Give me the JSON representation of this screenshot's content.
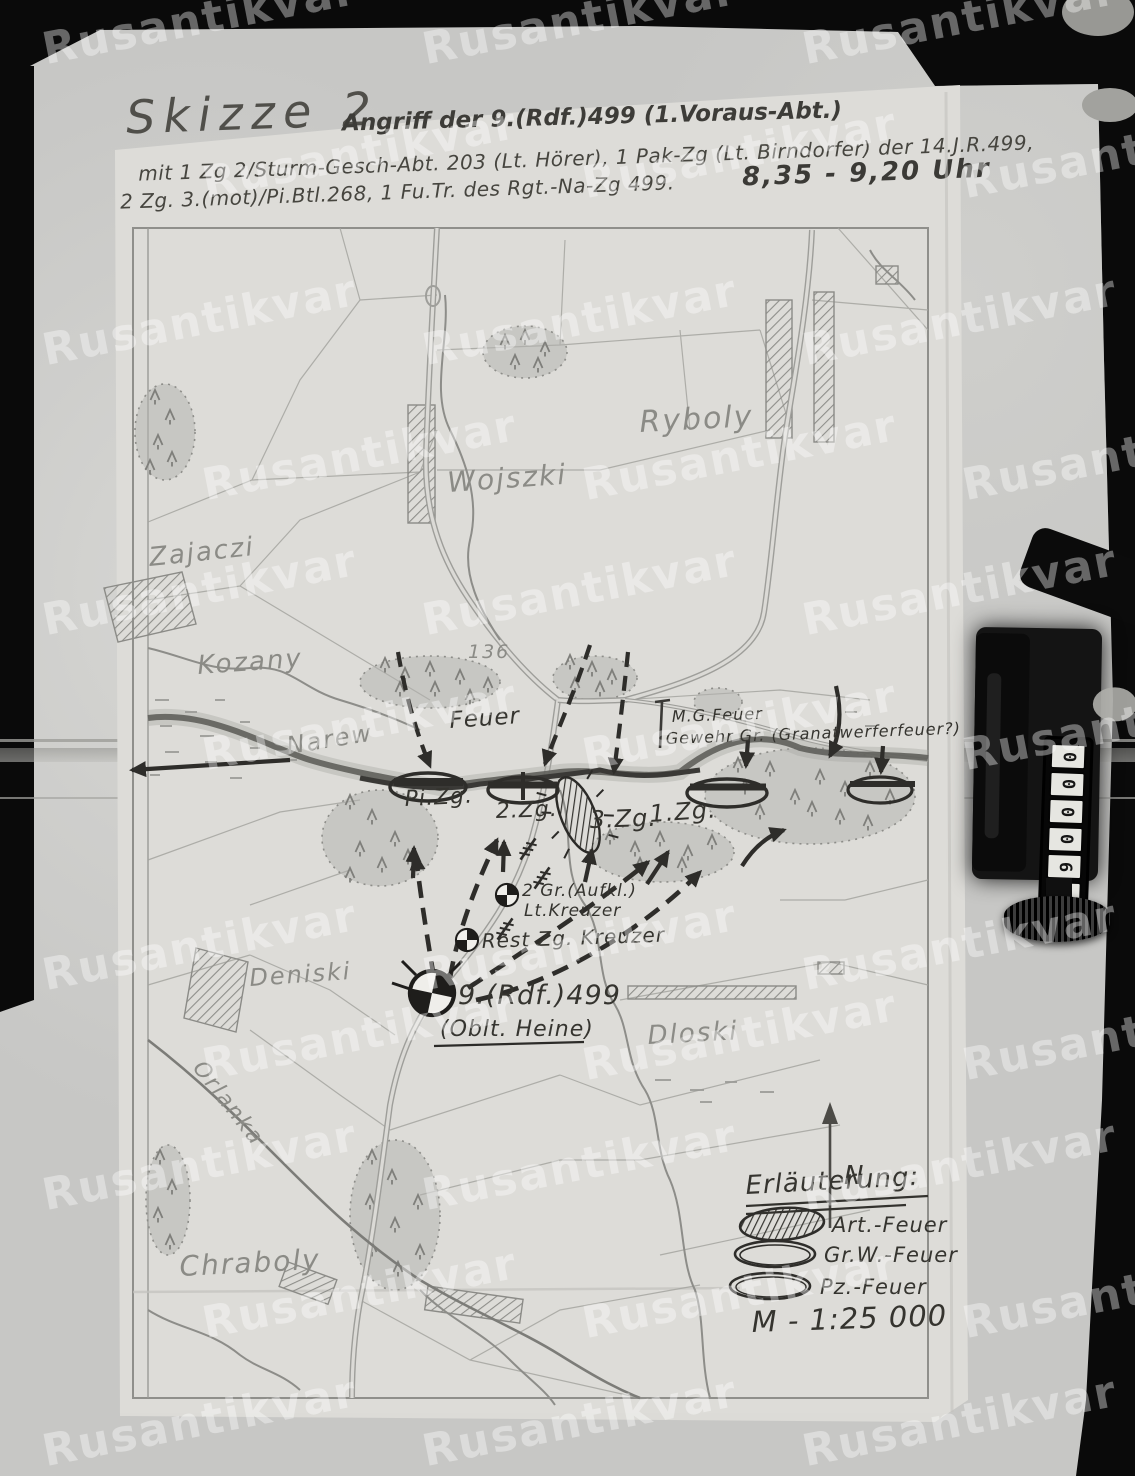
{
  "watermark_text": "Rusantikvar",
  "header": {
    "title": "Skizze 2",
    "subtitle": "Angriff der 9.(Rdf.)499 (1.Voraus-Abt.)",
    "line2": "mit 1 Zg 2/Sturm-Gesch-Abt. 203 (Lt. Hörer), 1 Pak-Zg (Lt. Birndorfer) der 14.J.R.499,",
    "line3": "2 Zg. 3.(mot)/Pi.Btl.268, 1 Fu.Tr. des Rgt.-Na-Zg 499.",
    "time": "8,35 - 9,20 Uhr"
  },
  "places": {
    "ryboly": "Ryboly",
    "wojszki": "Wojszki",
    "zajaczi": "Zajaczi",
    "kozany": "Kozany",
    "narew": "Narew",
    "deniski": "Deniski",
    "dloski": "Dloski",
    "chraboly": "Chraboly",
    "orlanka": "Orlanka",
    "height_136": "136"
  },
  "tactical": {
    "feuer": "Feuer",
    "mg_feuer": "M.G.Feuer",
    "gewehr_gr": "Gewehr Gr. (Granatwerferfeuer?)",
    "pi_zg": "Pi.Zg.",
    "zg2": "2.Zg.",
    "zg3": "3.Zg.",
    "zg1": "1.Zg.",
    "aufkl_line1": "2 Gr.(Aufkl.)",
    "aufkl_line2": "Lt.Kreuzer",
    "rest_zg": "Rest Zg. Kreuzer",
    "hq_unit": "9.(Rdf.)499",
    "hq_leader": "(Oblt. Heine)",
    "north": "N"
  },
  "legend": {
    "heading": "Erläuterung:",
    "art_feuer": "Art.-Feuer",
    "grw_feuer": "Gr.W.-Feuer",
    "pz_feuer": "Pz.-Feuer",
    "scale": "M - 1:25 000"
  },
  "counter": {
    "digits": [
      "0",
      "0",
      "0",
      "0",
      "6",
      "2"
    ]
  }
}
